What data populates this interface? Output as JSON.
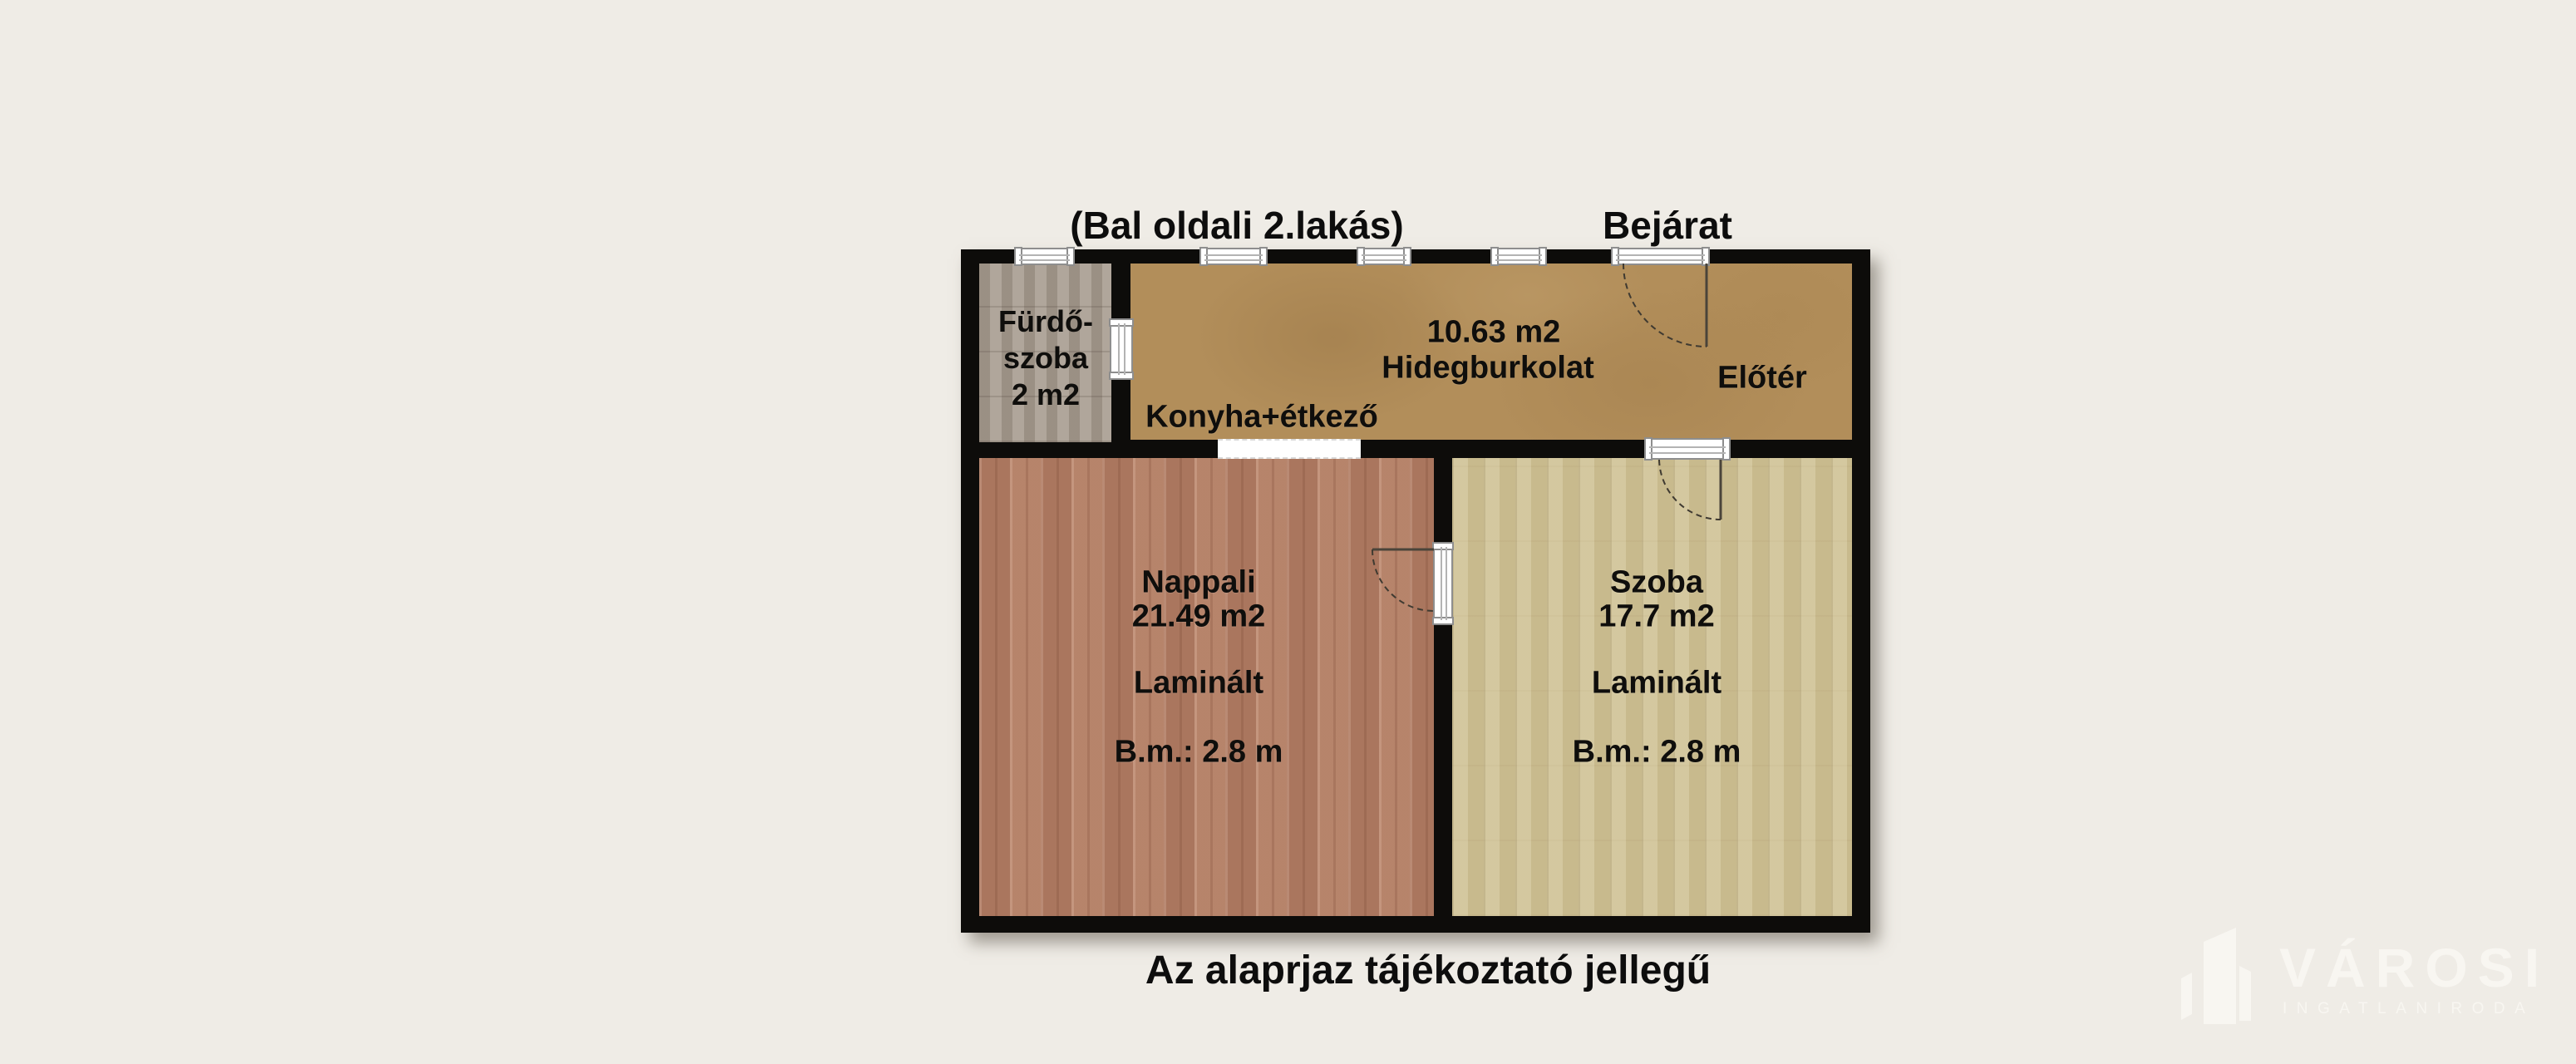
{
  "titles": {
    "unit": "(Bal oldali 2.lakás)",
    "entrance": "Bejárat"
  },
  "caption": "Az alaprjaz tájékoztató jellegű",
  "rooms": {
    "bathroom": {
      "name_line1": "Fürdő-",
      "name_line2": "szoba",
      "area": "2 m2"
    },
    "kitchen": {
      "area": "10.63 m2",
      "flooring": "Hidegburkolat",
      "name": "Konyha+étkező"
    },
    "hall": {
      "name": "Előtér"
    },
    "living_room": {
      "name": "Nappali",
      "area": "21.49 m2",
      "flooring": "Laminált",
      "ceiling_height": "B.m.: 2.8 m"
    },
    "bedroom": {
      "name": "Szoba",
      "area": "17.7 m2",
      "flooring": "Laminált",
      "ceiling_height": "B.m.: 2.8 m"
    }
  },
  "watermark": {
    "brand": "VÁROSI",
    "subtitle": "INGATLANIRODA"
  },
  "colors": {
    "background": "#efece6",
    "wall": "#0d0c0a",
    "bathroom_floor": "#a89d91",
    "kitchen_floor": "#b28e5a",
    "living_floor": "#b27f66",
    "bedroom_floor": "#cdbf93",
    "watermark": "#f8f6f1"
  }
}
